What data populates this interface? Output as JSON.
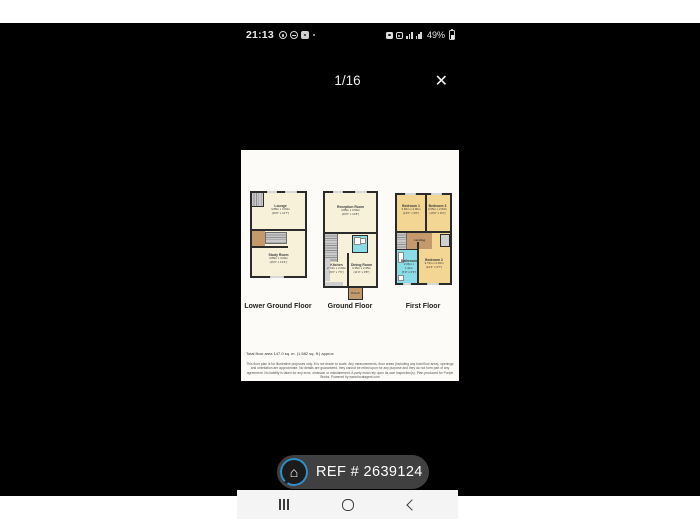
{
  "status_bar": {
    "time": "21:13",
    "battery_percent": "49%",
    "left_icons": [
      "whatsapp-icon",
      "alarm-icon",
      "app-badge-icon",
      "notification-dot-icon"
    ],
    "right_icons": [
      "screenshot-icon",
      "wifi-calling-icon",
      "signal-bars-icon",
      "signal-bars-icon",
      "battery-icon"
    ]
  },
  "viewer": {
    "page_indicator": "1/16",
    "close_glyph": "✕"
  },
  "floorplan": {
    "floors": [
      {
        "name": "Lower Ground Floor",
        "rooms": {
          "lounge": {
            "name": "Lounge",
            "metric": "4.88m x 3.53m",
            "imperial": "(16'0\" x 11'7\")"
          },
          "study": {
            "name": "Study Room",
            "metric": "4.88m x 4.06m",
            "imperial": "(16'0\" x 13'4\")"
          }
        }
      },
      {
        "name": "Ground Floor",
        "rooms": {
          "reception": {
            "name": "Reception Room",
            "metric": "4.88m x 3.56m",
            "imperial": "(16'0\" x 11'8\")"
          },
          "kitchen": {
            "name": "Kitchen",
            "metric": "2.74m x 2.29m",
            "imperial": "(9'0\" x 7'6\")"
          },
          "dining": {
            "name": "Dining Room",
            "metric": "3.35m x 2.95m",
            "imperial": "(11'0\" x 9'8\")"
          },
          "porch": {
            "name": "Porch"
          }
        }
      },
      {
        "name": "First Floor",
        "rooms": {
          "bedroom1": {
            "name": "Bedroom 1",
            "metric": "3.66m x 2.90m",
            "imperial": "(12'0\" x 9'6\")"
          },
          "bedroom3": {
            "name": "Bedroom 3",
            "metric": "3.05m x 2.84m",
            "imperial": "(10'0\" x 9'4\")"
          },
          "landing": {
            "name": "Landing"
          },
          "bathroom": {
            "name": "Bathroom",
            "metric": "2.06m x 1.91m",
            "imperial": "(6'9\" x 6'3\")"
          },
          "bedroom2": {
            "name": "Bedroom 2",
            "metric": "3.73m x 2.92m",
            "imperial": "(12'3\" x 9'7\")"
          }
        }
      }
    ],
    "total_area": "Total floor area 147.0 sq. m. (1,582 sq. ft.) approx",
    "disclaimer": "This floor plan is for illustrative purposes only. It is not drawn to scale. Any measurements, floor areas (including any total floor area), openings and orientation are approximate. No details are guaranteed, they cannot be relied upon for any purpose and they do not form part of any agreement. No liability is taken for any error, omission or misstatement. A party must rely upon its own inspection(s). Plan produced for Purple Bricks. Powered by www.focalagent.com",
    "colors": {
      "room_cream": "#f7f1d9",
      "room_bedroom": "#f3d694",
      "room_bathroom": "#8adde6",
      "room_hall": "#c49a6c",
      "wall": "#2b2b2b"
    }
  },
  "ref_badge": {
    "text": "REF # 2639124",
    "house_glyph": "⌂"
  },
  "nav_bar": {
    "icons": [
      "recents-icon",
      "home-icon",
      "back-icon"
    ]
  }
}
